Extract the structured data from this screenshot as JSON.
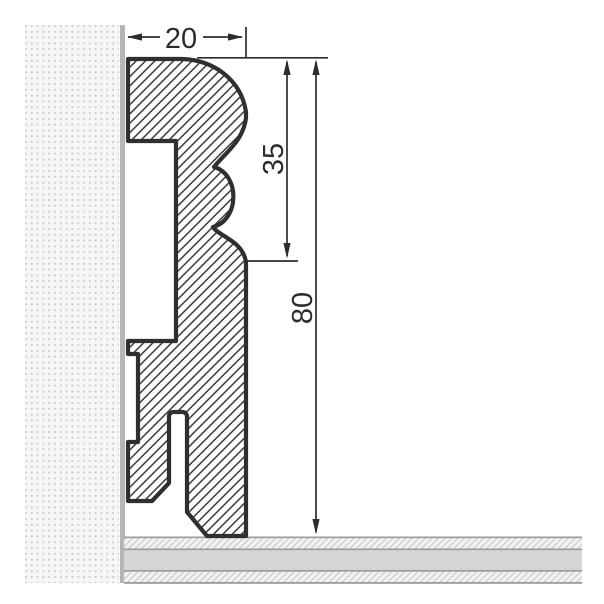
{
  "drawing": {
    "labels": {
      "width": "20",
      "upper_height": "35",
      "total_height": "80"
    }
  },
  "colors": {
    "dim_color": "#2c2c2c",
    "outline_color": "#2f2f2f",
    "hatch_line": "#3a3a3a",
    "wall_bg": "#f6f6f6",
    "wall_dot": "#c9c9c9",
    "wall_edge": "#b5b5b5",
    "floor_line": "#9a9a9a",
    "floor_band": "#d5d5d5",
    "floor_hatch_bg": "#f2f2f2",
    "floor_hatch_line": "#c3c3c3"
  }
}
